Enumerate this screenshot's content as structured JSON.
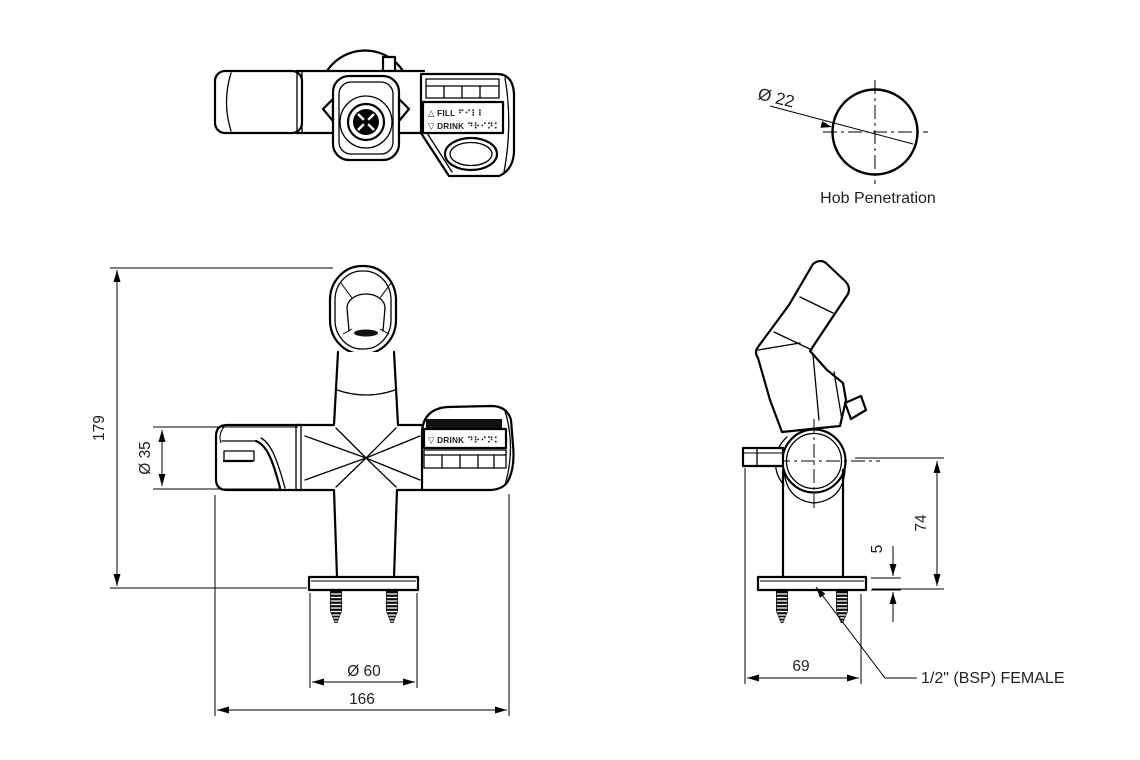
{
  "labels": {
    "hob_penetration": "Hob Penetration",
    "bsp_female": "1/2\" (BSP) FEMALE",
    "fill": "△ FILL ⠋⠊⠇⠇",
    "drink": "▽ DRINK ⠙⠗⠊⠝⠅"
  },
  "dimensions": {
    "overall_height_mm": "179",
    "spout_diameter_mm": "Ø 35",
    "flange_diameter_mm": "Ø 60",
    "overall_width_mm": "166",
    "hob_hole_diameter_mm": "Ø 22",
    "height_above_hob_mm": "74",
    "flange_thickness_mm": "5",
    "base_depth_mm": "69"
  },
  "colors": {
    "line": "#000000",
    "text": "#231f20",
    "background": "#ffffff"
  }
}
